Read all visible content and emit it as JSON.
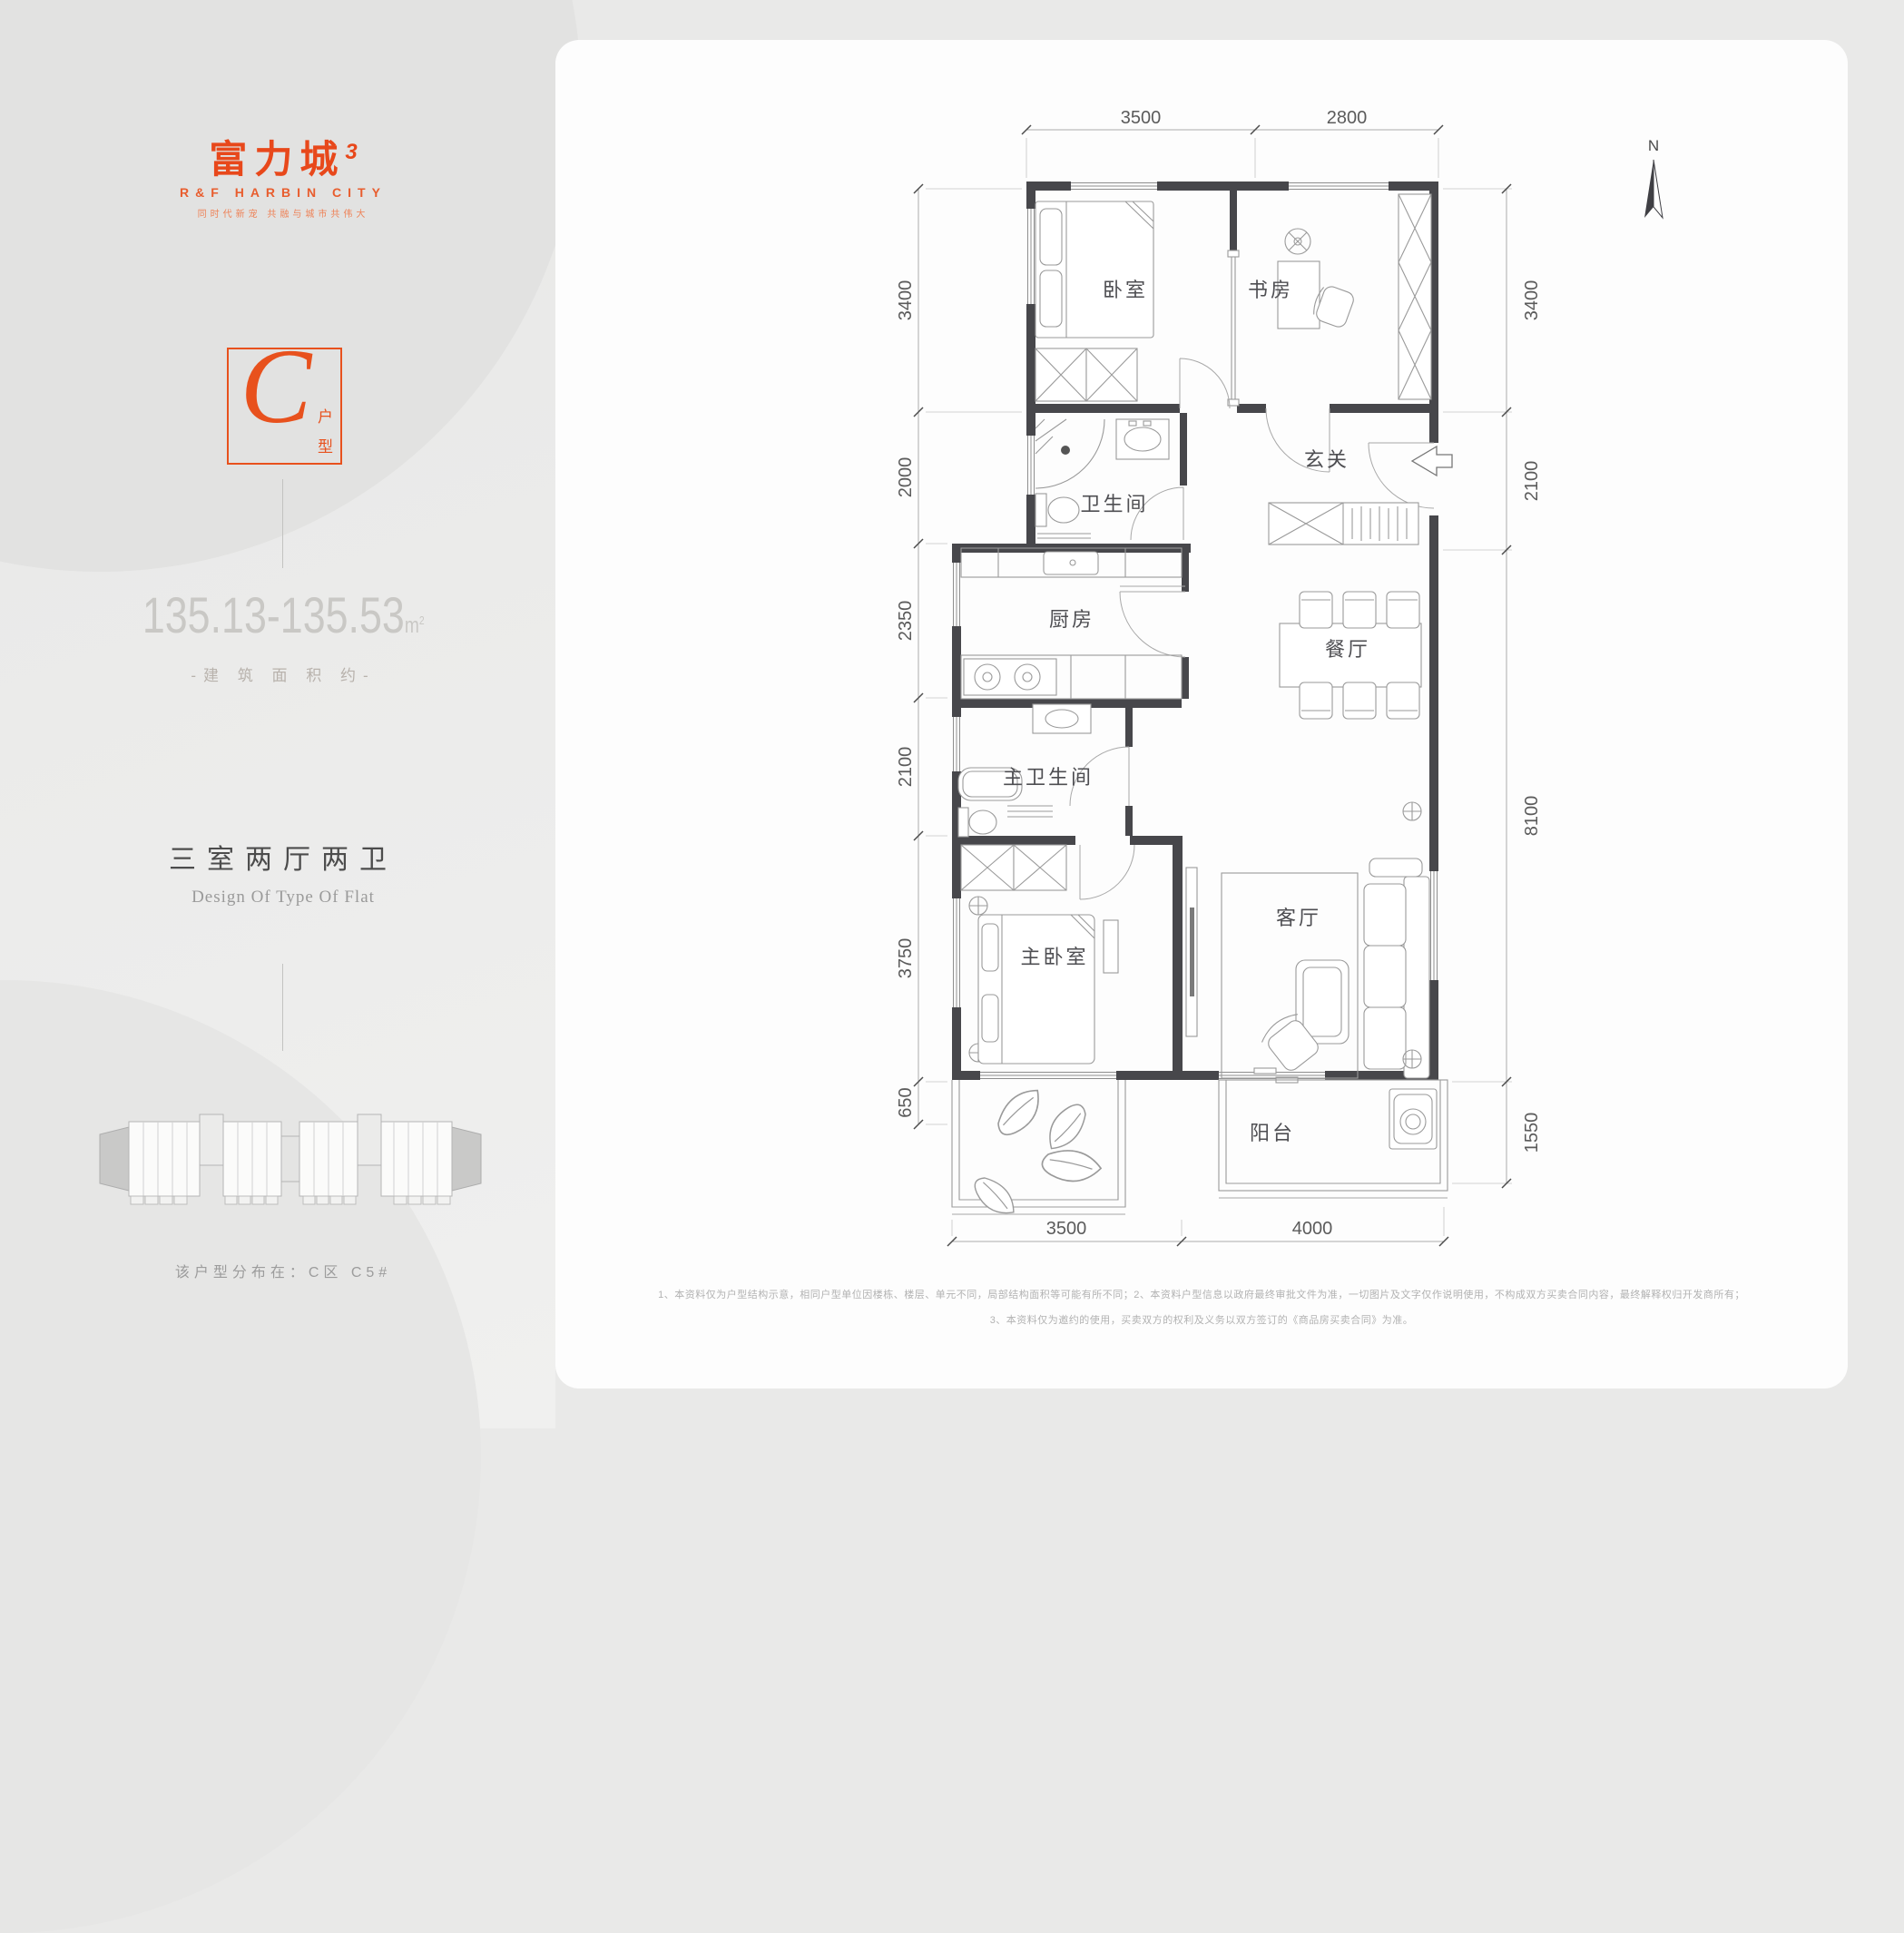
{
  "colors": {
    "accent": "#e8511d",
    "wall": "#47474b",
    "furniture_line": "#9a9a9a",
    "dim_text": "#5b5b5b"
  },
  "brand": {
    "logo_main": "富力城",
    "logo_sup": "3",
    "logo_sub": "R&F HARBIN CITY",
    "slogan": "同时代新宠 共融与城市共伟大"
  },
  "unit": {
    "letter": "C",
    "type_chars": [
      "户",
      "型"
    ]
  },
  "area": {
    "value": "135.13-135.53",
    "unit_main": "m",
    "unit_sup": "2",
    "caption": "-建 筑 面 积 约-"
  },
  "layout": {
    "title": "三室两厅两卫",
    "subtitle": "Design Of Type Of Flat"
  },
  "distribution": "该户型分布在：C区  C5#",
  "plan": {
    "north": "N",
    "rooms": {
      "bedroom": "卧室",
      "study": "书房",
      "foyer": "玄关",
      "bath": "卫生间",
      "kitchen": "厨房",
      "dining": "餐厅",
      "master_bath": "主卫生间",
      "master_bed": "主卧室",
      "living": "客厅",
      "balcony": "阳台"
    },
    "dims": {
      "top": [
        "3500",
        "2800"
      ],
      "bottom": [
        "3500",
        "4000"
      ],
      "left": [
        "3400",
        "2000",
        "2350",
        "2100",
        "3750",
        "650"
      ],
      "right": [
        "3400",
        "2100",
        "8100",
        "1550"
      ]
    }
  },
  "disclaimer": {
    "line1": "1、本资料仅为户型结构示意，相同户型单位因楼栋、楼层、单元不同，局部结构面积等可能有所不同；2、本资料户型信息以政府最终审批文件为准，一切图片及文字仅作说明使用，不构成双方买卖合同内容，最终解释权归开发商所有；",
    "line2": "3、本资料仅为邀约的使用，买卖双方的权利及义务以双方签订的《商品房买卖合同》为准。"
  }
}
